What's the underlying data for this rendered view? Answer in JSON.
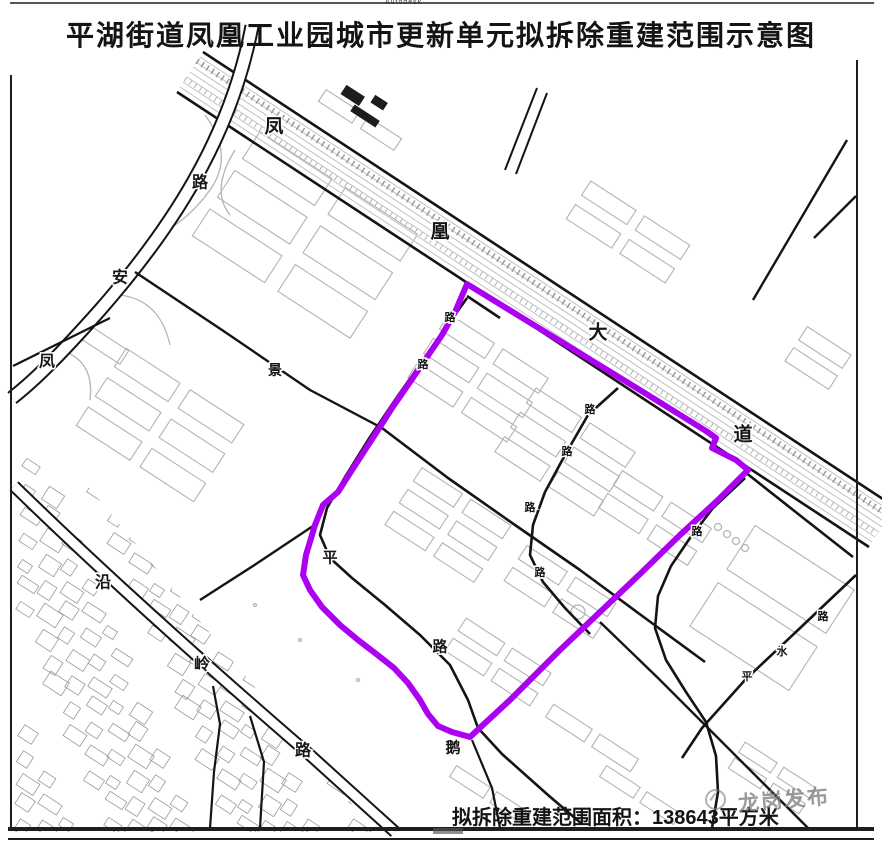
{
  "title": "平湖街道凤凰工业园城市更新单元拟拆除重建范围示意图",
  "stamp": "Autodesk",
  "footer": {
    "label": "拟拆除重建范围面积：138643平方米",
    "area_prefix": "拟拆除重建范围面积：",
    "area_value": "138643",
    "area_unit": "平方米"
  },
  "watermark": {
    "text": "龙岗发布"
  },
  "boundary": {
    "name": "拟拆除重建范围",
    "color": "#AC00F0",
    "area_sqm": "138643"
  },
  "roads": [
    {
      "name": "凤凰大道"
    },
    {
      "name": "凤安路"
    },
    {
      "name": "沿岭路"
    }
  ],
  "labels": [
    {
      "text": "凤",
      "x": 274,
      "y": 127,
      "size": 19
    },
    {
      "text": "凰",
      "x": 440,
      "y": 232,
      "size": 19
    },
    {
      "text": "大",
      "x": 598,
      "y": 333,
      "size": 19
    },
    {
      "text": "道",
      "x": 743,
      "y": 435,
      "size": 19
    },
    {
      "text": "路",
      "x": 200,
      "y": 183,
      "size": 16
    },
    {
      "text": "安",
      "x": 120,
      "y": 278,
      "size": 16
    },
    {
      "text": "凤",
      "x": 47,
      "y": 362,
      "size": 16
    },
    {
      "text": "沿",
      "x": 103,
      "y": 583,
      "size": 16
    },
    {
      "text": "岭",
      "x": 202,
      "y": 665,
      "size": 16
    },
    {
      "text": "路",
      "x": 303,
      "y": 751,
      "size": 16
    },
    {
      "text": "平",
      "x": 330,
      "y": 558,
      "size": 15
    },
    {
      "text": "路",
      "x": 440,
      "y": 647,
      "size": 15
    },
    {
      "text": "鹅",
      "x": 453,
      "y": 748,
      "size": 15
    },
    {
      "text": "景",
      "x": 275,
      "y": 370,
      "size": 14
    },
    {
      "text": "路",
      "x": 450,
      "y": 318,
      "size": 11
    },
    {
      "text": "路",
      "x": 423,
      "y": 365,
      "size": 11
    },
    {
      "text": "路",
      "x": 590,
      "y": 410,
      "size": 11
    },
    {
      "text": "路",
      "x": 567,
      "y": 452,
      "size": 11
    },
    {
      "text": "路",
      "x": 530,
      "y": 508,
      "size": 11
    },
    {
      "text": "路",
      "x": 540,
      "y": 573,
      "size": 11
    },
    {
      "text": "路",
      "x": 697,
      "y": 532,
      "size": 11
    },
    {
      "text": "路",
      "x": 823,
      "y": 617,
      "size": 11
    },
    {
      "text": "水",
      "x": 782,
      "y": 652,
      "size": 11
    },
    {
      "text": "平",
      "x": 747,
      "y": 677,
      "size": 11
    }
  ],
  "colors": {
    "road": "#161616",
    "building": "#b3b3b3",
    "village": "#9a9a9a",
    "frame": "#1e1e1e",
    "watermark": "#7d7d7d"
  }
}
